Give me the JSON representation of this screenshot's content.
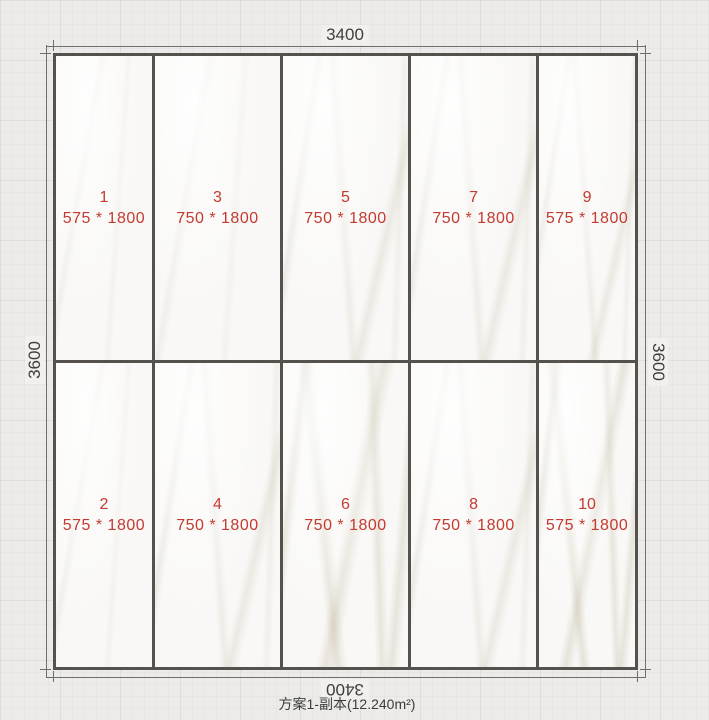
{
  "wall": {
    "width_mm": "3400",
    "height_mm": "3600",
    "column_widths_mm": [
      575,
      750,
      750,
      750,
      575
    ],
    "row_heights_mm": [
      1800,
      1800
    ]
  },
  "dimensions": {
    "top": "3400",
    "bottom": "3400",
    "left": "3600",
    "right": "3600"
  },
  "scheme": {
    "caption": "方案1-副本(12.240m²)"
  },
  "tiles": [
    {
      "number": "1",
      "size": "575 * 1800",
      "row": 1,
      "col": 1,
      "veins": "light"
    },
    {
      "number": "3",
      "size": "750 * 1800",
      "row": 1,
      "col": 2,
      "veins": "light"
    },
    {
      "number": "5",
      "size": "750 * 1800",
      "row": 1,
      "col": 3,
      "veins": "medium"
    },
    {
      "number": "7",
      "size": "750 * 1800",
      "row": 1,
      "col": 4,
      "veins": "medium"
    },
    {
      "number": "9",
      "size": "575 * 1800",
      "row": 1,
      "col": 5,
      "veins": "medium"
    },
    {
      "number": "2",
      "size": "575 * 1800",
      "row": 2,
      "col": 1,
      "veins": "light"
    },
    {
      "number": "4",
      "size": "750 * 1800",
      "row": 2,
      "col": 2,
      "veins": "medium"
    },
    {
      "number": "6",
      "size": "750 * 1800",
      "row": 2,
      "col": 3,
      "veins": "heavy"
    },
    {
      "number": "8",
      "size": "750 * 1800",
      "row": 2,
      "col": 4,
      "veins": "medium"
    },
    {
      "number": "10",
      "size": "575 * 1800",
      "row": 2,
      "col": 5,
      "veins": "heavy"
    }
  ],
  "colors": {
    "label_red": "#c43a30",
    "tile_border": "#55524d",
    "dimension_text": "#3e3e3d",
    "background": "#ecebe9"
  }
}
